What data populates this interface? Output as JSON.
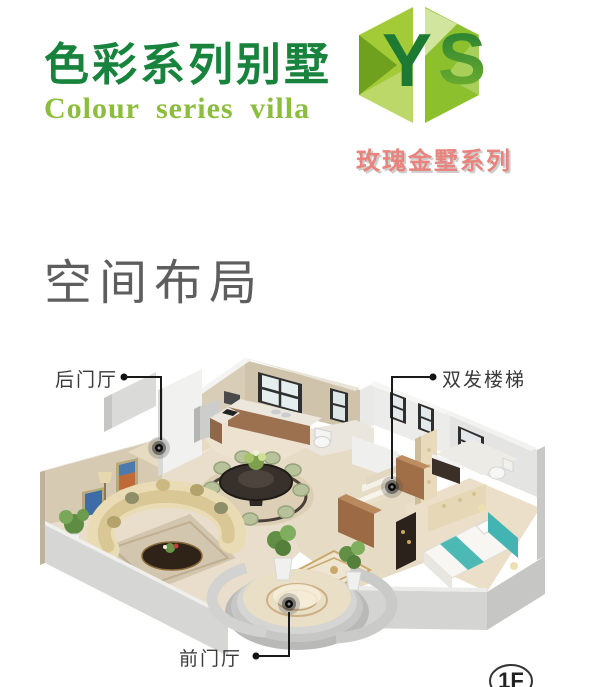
{
  "header": {
    "title_cn": "色彩系列别墅",
    "title_en": "Colour series villa",
    "logo": {
      "letter_y": "Y",
      "letter_s": "S"
    },
    "series_label": "玫瑰金墅系列"
  },
  "section": {
    "heading": "空间布局"
  },
  "floorplan": {
    "labels": {
      "back_hall": "后门厅",
      "stairs": "双发楼梯",
      "front_hall": "前门厅"
    },
    "floor_badge": "1F"
  },
  "colors": {
    "title_green": "#17833c",
    "subtitle_green": "#8cbd3e",
    "series_pink": "#e8837d",
    "heading_gray": "#5e5e5e",
    "label_dark": "#3a3a3a",
    "logo_green_dark": "#1e7a33",
    "logo_green_light": "#9bc832",
    "wall_light": "#ededeb",
    "floor_beige": "#e8decb",
    "sofa_cream": "#e9dcb4",
    "wood_brown": "#9b7150",
    "accent_teal": "#4db9b5"
  }
}
